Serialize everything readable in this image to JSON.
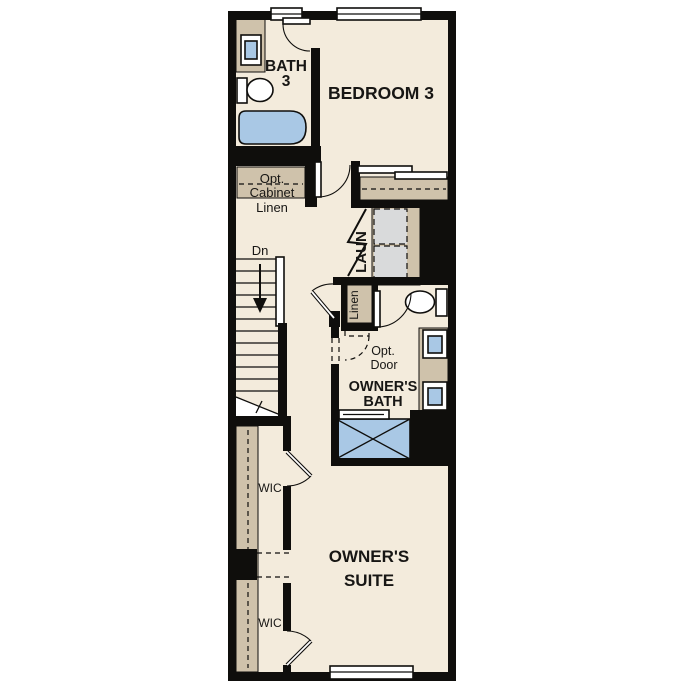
{
  "colors": {
    "floor": "#f3ebdc",
    "wall": "#0f0e0c",
    "tan": "#cfc2ab",
    "blue": "#a9c8e5",
    "gray": "#d9dadb",
    "white": "#ffffff",
    "text": "#171614"
  },
  "rooms": {
    "bath3": {
      "line1": "BATH",
      "line2": "3"
    },
    "bedroom3": {
      "label": "BEDROOM 3"
    },
    "opt_cabinet": {
      "line1": "Opt.",
      "line2": "Cabinet"
    },
    "linen_upper": {
      "label": "Linen"
    },
    "stairs": {
      "label": "Dn"
    },
    "laundry": {
      "label": "LAUN"
    },
    "linen_lower": {
      "label": "Linen"
    },
    "opt_door": {
      "line1": "Opt.",
      "line2": "Door"
    },
    "owners_bath": {
      "line1": "OWNER'S",
      "line2": "BATH"
    },
    "wic_upper": {
      "label": "WIC"
    },
    "owners_suite": {
      "line1": "OWNER'S",
      "line2": "SUITE"
    },
    "wic_lower": {
      "label": "WIC"
    }
  }
}
